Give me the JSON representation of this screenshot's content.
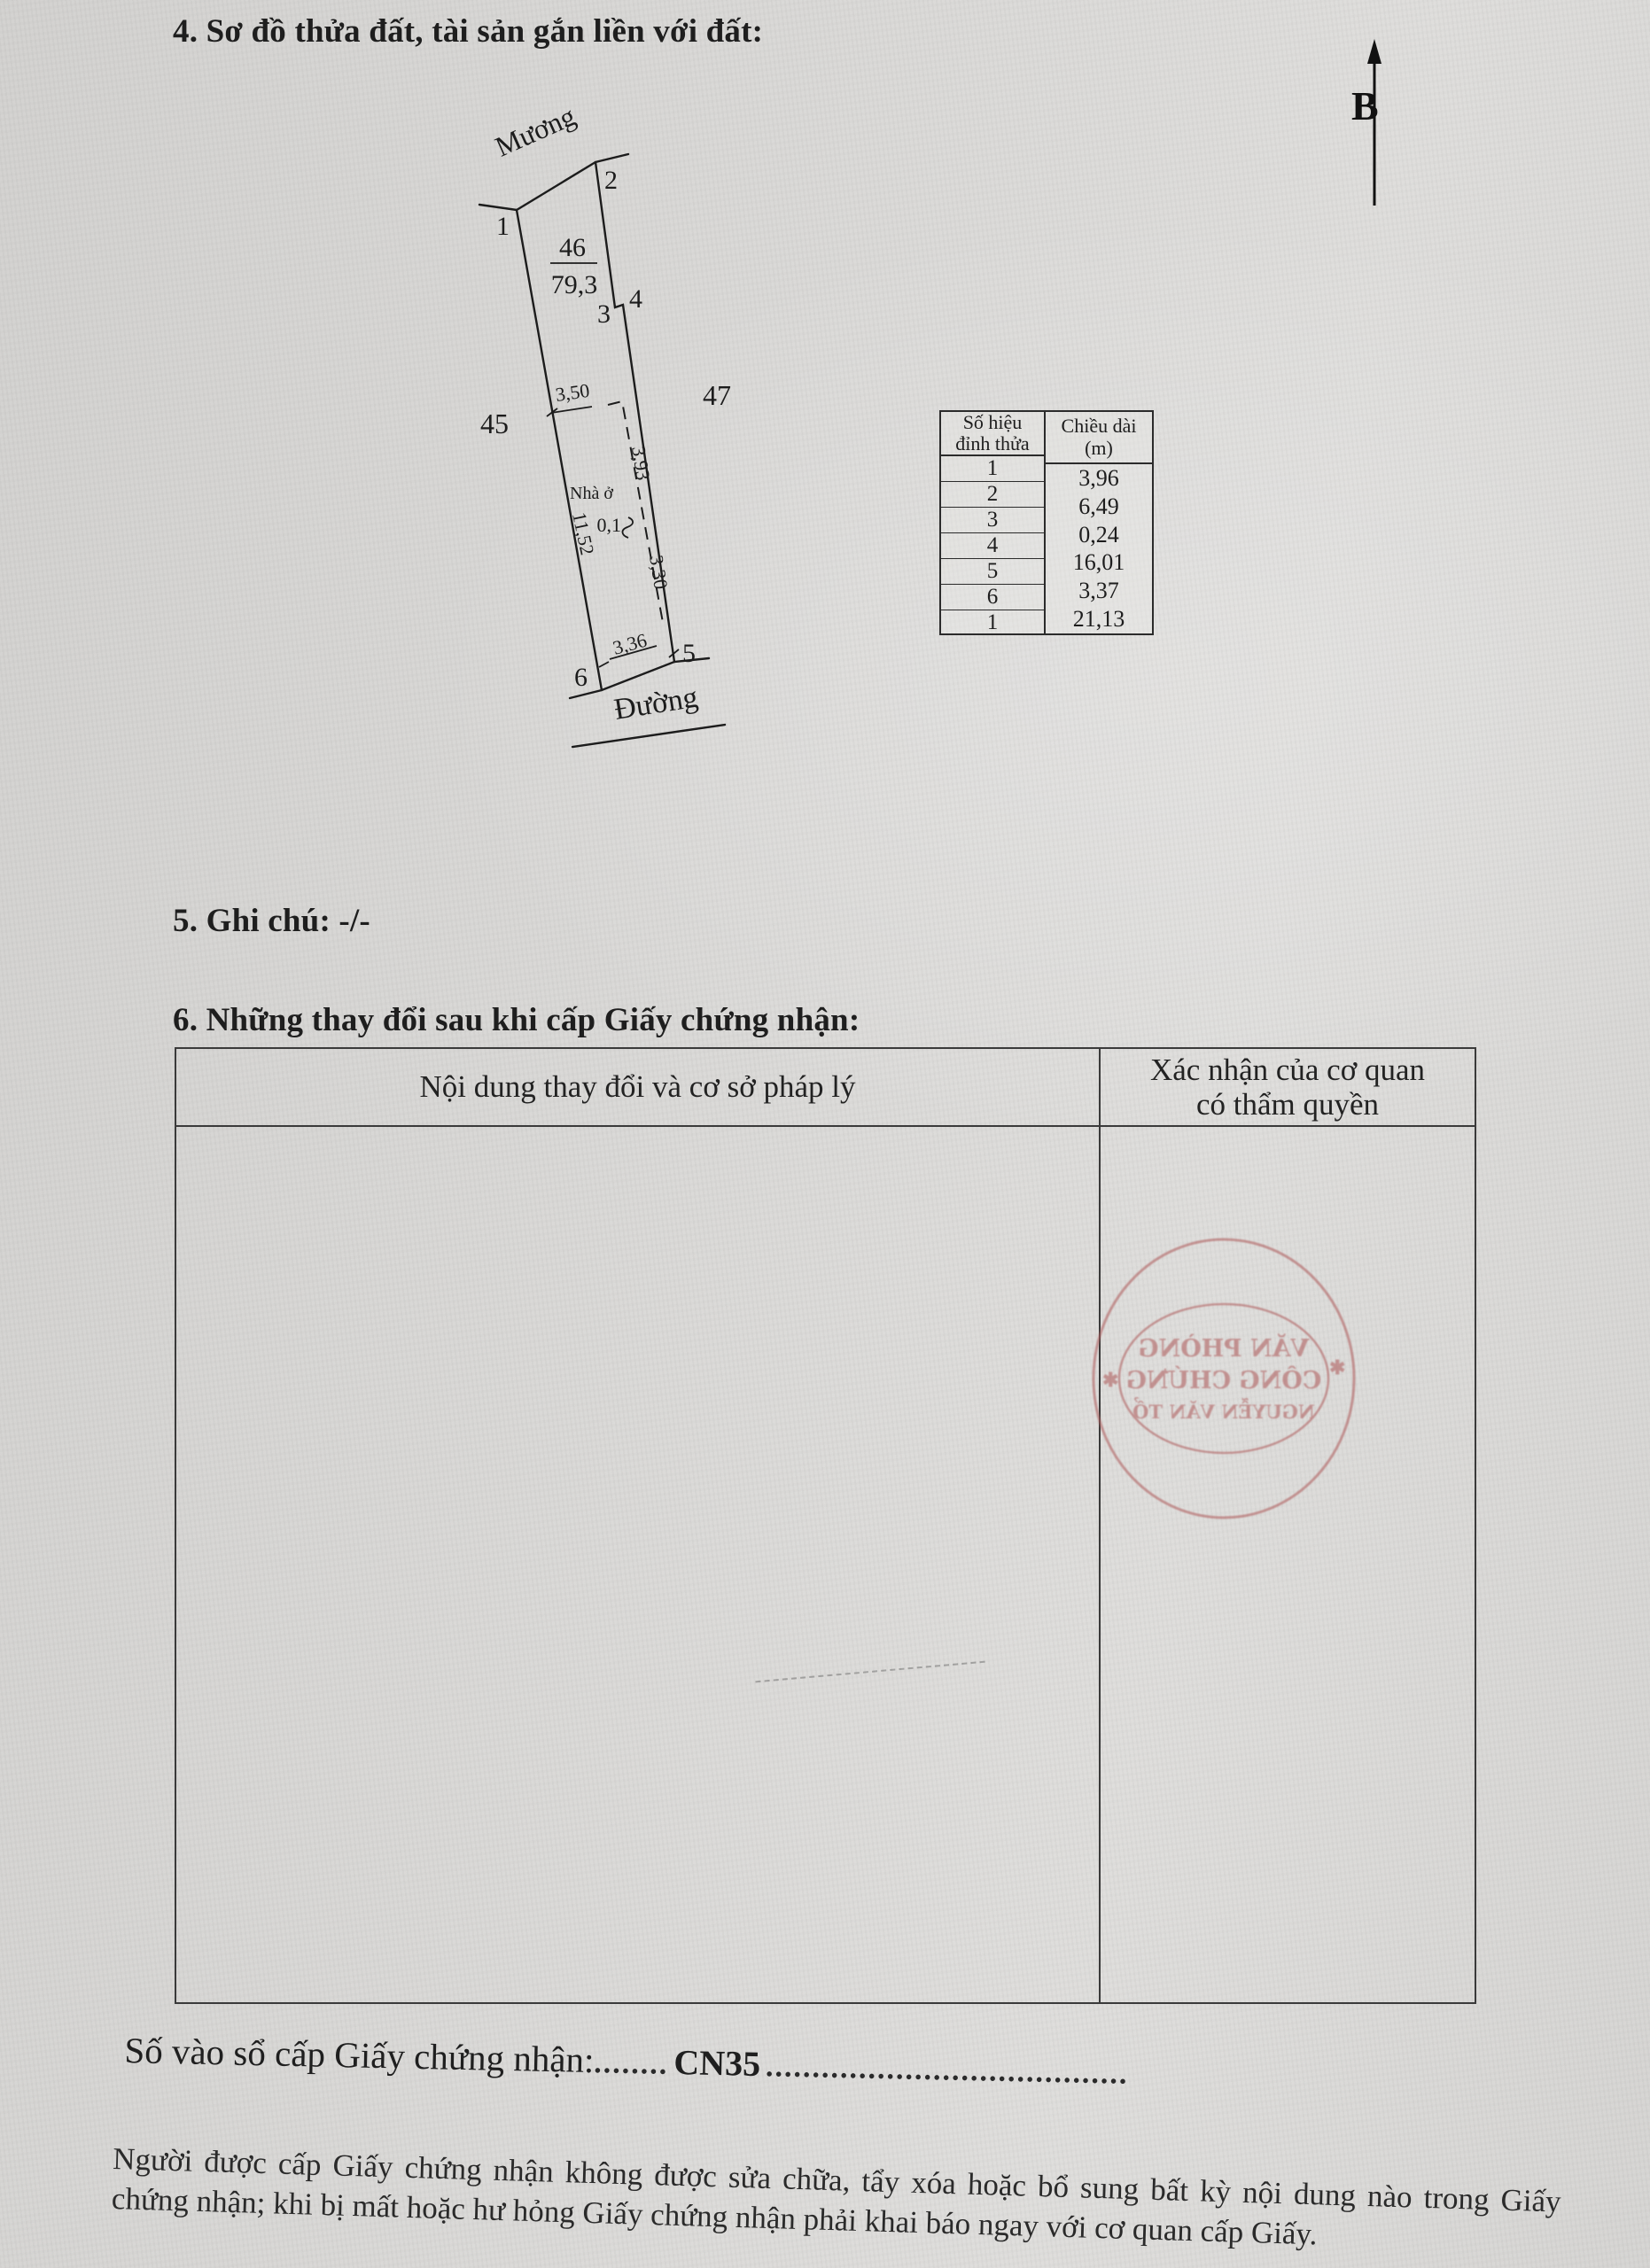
{
  "section4": {
    "title": "4. Sơ đồ thửa đất, tài sản gắn liền với đất:"
  },
  "diagram": {
    "north_label": "B",
    "canal_label": "Mương",
    "road_label": "Đường",
    "parcel_number": "46",
    "parcel_area": "79,3",
    "left_parcel": "45",
    "right_parcel": "47",
    "house_label": "Nhà ở",
    "vertex_1": "1",
    "vertex_2": "2",
    "vertex_3": "3",
    "vertex_4": "4",
    "vertex_5": "5",
    "vertex_6": "6",
    "dim_top_width": "3,50",
    "dim_house_upper": "3,93",
    "dim_house_gap": "0,1",
    "dim_house_lower": "3,30",
    "dim_left_edge": "11,52",
    "dim_bottom_width": "3,36"
  },
  "edge_table": {
    "header_vertex": "Số hiệu đỉnh thửa",
    "header_length": "Chiều dài (m)",
    "vertex_numbers": [
      "1",
      "2",
      "3",
      "4",
      "5",
      "6",
      "1"
    ],
    "lengths": [
      "3,96",
      "6,49",
      "0,24",
      "16,01",
      "3,37",
      "21,13"
    ]
  },
  "section5": {
    "title": "5. Ghi chú: -/-"
  },
  "section6": {
    "title": "6. Những thay đổi sau khi cấp Giấy chứng nhận:",
    "col1_header": "Nội dung thay đổi và cơ sở pháp lý",
    "col2_header_line1": "Xác nhận của cơ quan",
    "col2_header_line2": "có thẩm quyền"
  },
  "stamp": {
    "line1": "VĂN PHÒNG",
    "line2": "CÔNG CHỨNG",
    "line3": "NGUYỄN VĂN TỔ",
    "star_left": "✱",
    "star_right": "✱",
    "color": "#b06060"
  },
  "registry": {
    "label": "Số vào sổ cấp Giấy chứng nhận:",
    "dots_before": "........",
    "value": "CN35",
    "dots_after": "......................................."
  },
  "footer": {
    "text": "Người được cấp Giấy chứng nhận không được sửa chữa, tẩy xóa hoặc bổ sung bất kỳ nội dung nào trong Giấy chứng nhận; khi bị mất hoặc hư hỏng Giấy chứng nhận phải khai báo ngay với cơ quan cấp Giấy."
  }
}
